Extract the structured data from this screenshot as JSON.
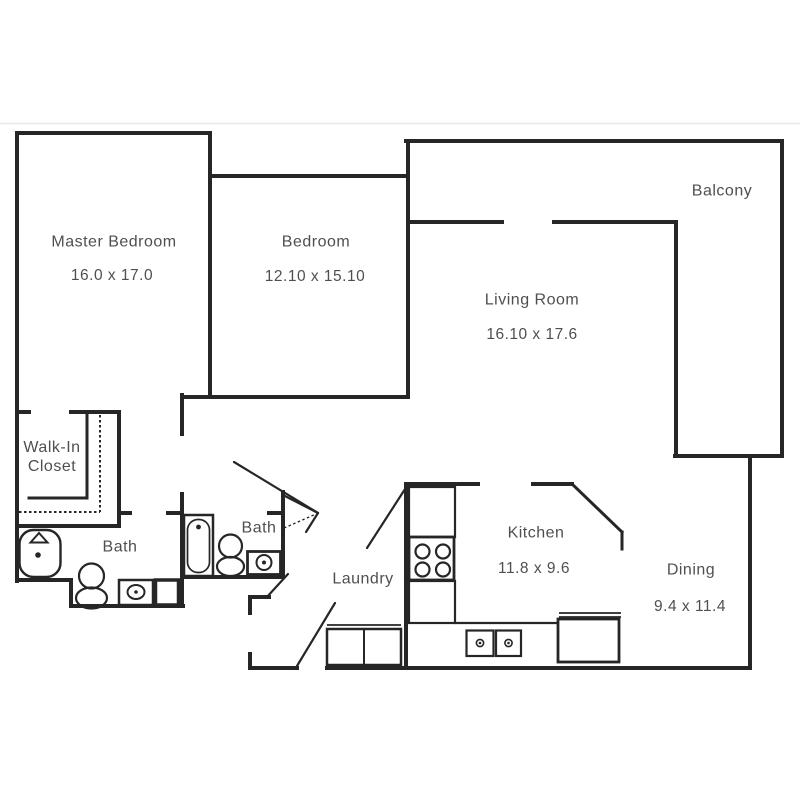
{
  "page": {
    "background": "#ffffff",
    "top_divider_color": "#e7e7e3"
  },
  "plan": {
    "wall_color": "#262626",
    "label_color": "#4f4f4f",
    "rooms": [
      {
        "id": "master-bedroom",
        "name": "Master Bedroom",
        "dimensions": "16.0 x 17.0"
      },
      {
        "id": "bedroom",
        "name": "Bedroom",
        "dimensions": "12.10 x 15.10"
      },
      {
        "id": "living-room",
        "name": "Living Room",
        "dimensions": "16.10 x 17.6"
      },
      {
        "id": "balcony",
        "name": "Balcony",
        "dimensions": ""
      },
      {
        "id": "walk-in-closet",
        "name": "Walk-In Closet",
        "dimensions": ""
      },
      {
        "id": "master-bath",
        "name": "Bath",
        "dimensions": ""
      },
      {
        "id": "bath",
        "name": "Bath",
        "dimensions": ""
      },
      {
        "id": "laundry",
        "name": "Laundry",
        "dimensions": ""
      },
      {
        "id": "kitchen",
        "name": "Kitchen",
        "dimensions": "11.8 x 9.6"
      },
      {
        "id": "dining",
        "name": "Dining",
        "dimensions": "9.4 x 11.4"
      }
    ]
  }
}
